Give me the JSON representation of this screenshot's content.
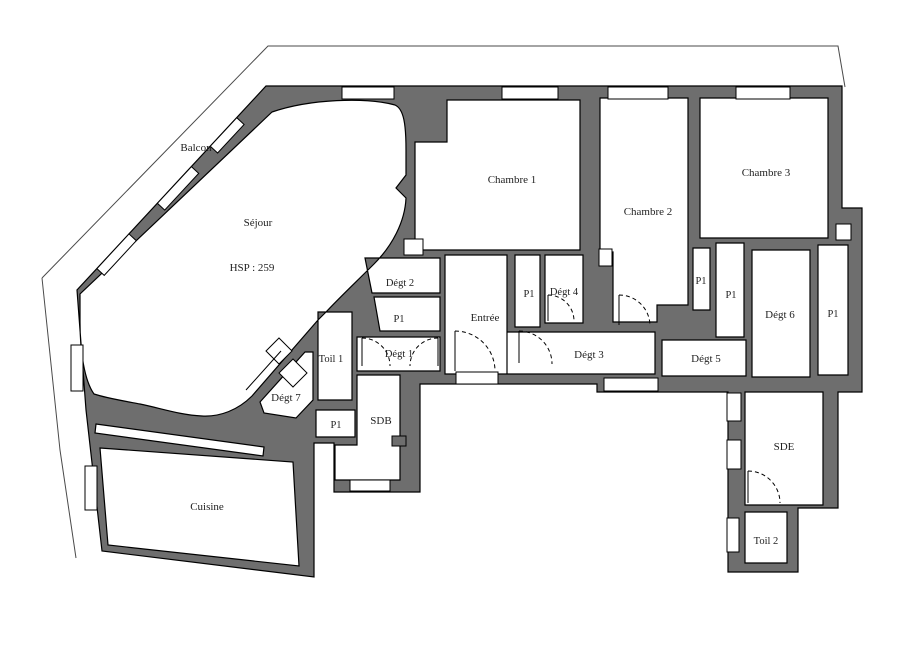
{
  "canvas": {
    "width": 901,
    "height": 646
  },
  "colors": {
    "wall": "#6e6e6e",
    "outline": "#000000",
    "background": "#ffffff",
    "label": "#1f1f1f",
    "property_line": "#4a4a4a"
  },
  "rooms": [
    {
      "id": "balcon",
      "label": "Balcon",
      "x": 196,
      "y": 151,
      "size": 11
    },
    {
      "id": "sejour",
      "label": "Séjour",
      "x": 258,
      "y": 226,
      "size": 11
    },
    {
      "id": "sejour-hsp",
      "label": "HSP : 259",
      "x": 252,
      "y": 271,
      "size": 11
    },
    {
      "id": "chambre-1",
      "label": "Chambre 1",
      "x": 512,
      "y": 183,
      "size": 11
    },
    {
      "id": "chambre-2",
      "label": "Chambre 2",
      "x": 648,
      "y": 215,
      "size": 11
    },
    {
      "id": "chambre-3",
      "label": "Chambre 3",
      "x": 766,
      "y": 176,
      "size": 11
    },
    {
      "id": "degt-2",
      "label": "Dégt 2",
      "x": 400,
      "y": 286,
      "size": 10.5
    },
    {
      "id": "p1-degt2",
      "label": "P1",
      "x": 399,
      "y": 322,
      "size": 10.5
    },
    {
      "id": "degt-1",
      "label": "Dégt 1",
      "x": 399,
      "y": 357,
      "size": 10.5
    },
    {
      "id": "entree",
      "label": "Entrée",
      "x": 485,
      "y": 321,
      "size": 11
    },
    {
      "id": "p1-entree",
      "label": "P1",
      "x": 529,
      "y": 297,
      "size": 10.5
    },
    {
      "id": "degt-4",
      "label": "Dégt 4",
      "x": 564,
      "y": 295,
      "size": 10.5
    },
    {
      "id": "degt-3",
      "label": "Dégt 3",
      "x": 589,
      "y": 358,
      "size": 11
    },
    {
      "id": "degt-5",
      "label": "Dégt 5",
      "x": 706,
      "y": 362,
      "size": 11
    },
    {
      "id": "p1-a",
      "label": "P1",
      "x": 701,
      "y": 284,
      "size": 10.5
    },
    {
      "id": "p1-b",
      "label": "P1",
      "x": 731,
      "y": 298,
      "size": 10.5
    },
    {
      "id": "degt-6",
      "label": "Dégt 6",
      "x": 780,
      "y": 318,
      "size": 11
    },
    {
      "id": "p1-f",
      "label": "P1",
      "x": 833,
      "y": 317,
      "size": 10.5
    },
    {
      "id": "toil-1",
      "label": "Toil 1",
      "x": 331,
      "y": 362,
      "size": 10.5
    },
    {
      "id": "degt-7",
      "label": "Dégt 7",
      "x": 286,
      "y": 401,
      "size": 11
    },
    {
      "id": "p1-d",
      "label": "P1",
      "x": 336,
      "y": 428,
      "size": 10.5
    },
    {
      "id": "sdb",
      "label": "SDB",
      "x": 381,
      "y": 424,
      "size": 11
    },
    {
      "id": "cuisine",
      "label": "Cuisine",
      "x": 207,
      "y": 510,
      "size": 11
    },
    {
      "id": "sde",
      "label": "SDE",
      "x": 784,
      "y": 450,
      "size": 11
    },
    {
      "id": "toil-2",
      "label": "Toil 2",
      "x": 766,
      "y": 544,
      "size": 10.5
    }
  ]
}
